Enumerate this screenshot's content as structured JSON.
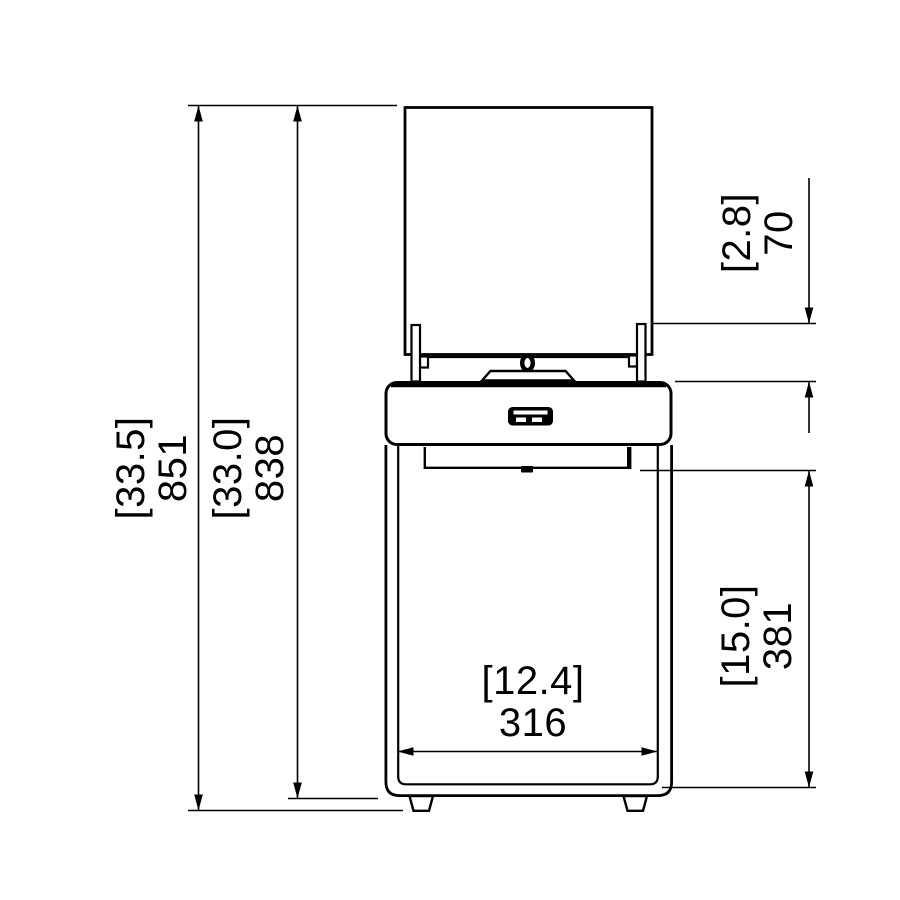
{
  "drawing": {
    "type": "technical-dimension-drawing",
    "view": "front elevation",
    "colors": {
      "line": "#000000",
      "background": "#ffffff",
      "text": "#000000"
    },
    "units": {
      "bracketed": "inches",
      "plain": "millimeters"
    }
  },
  "dimensions": {
    "dim_851": {
      "bracket": "[33.5]",
      "value": "851"
    },
    "dim_838": {
      "bracket": "[33.0]",
      "value": "838"
    },
    "dim_70": {
      "bracket": "[2.8]",
      "value": "70"
    },
    "dim_381": {
      "bracket": "[15.0]",
      "value": "381"
    },
    "dim_316": {
      "bracket": "[12.4]",
      "value": "316"
    }
  }
}
